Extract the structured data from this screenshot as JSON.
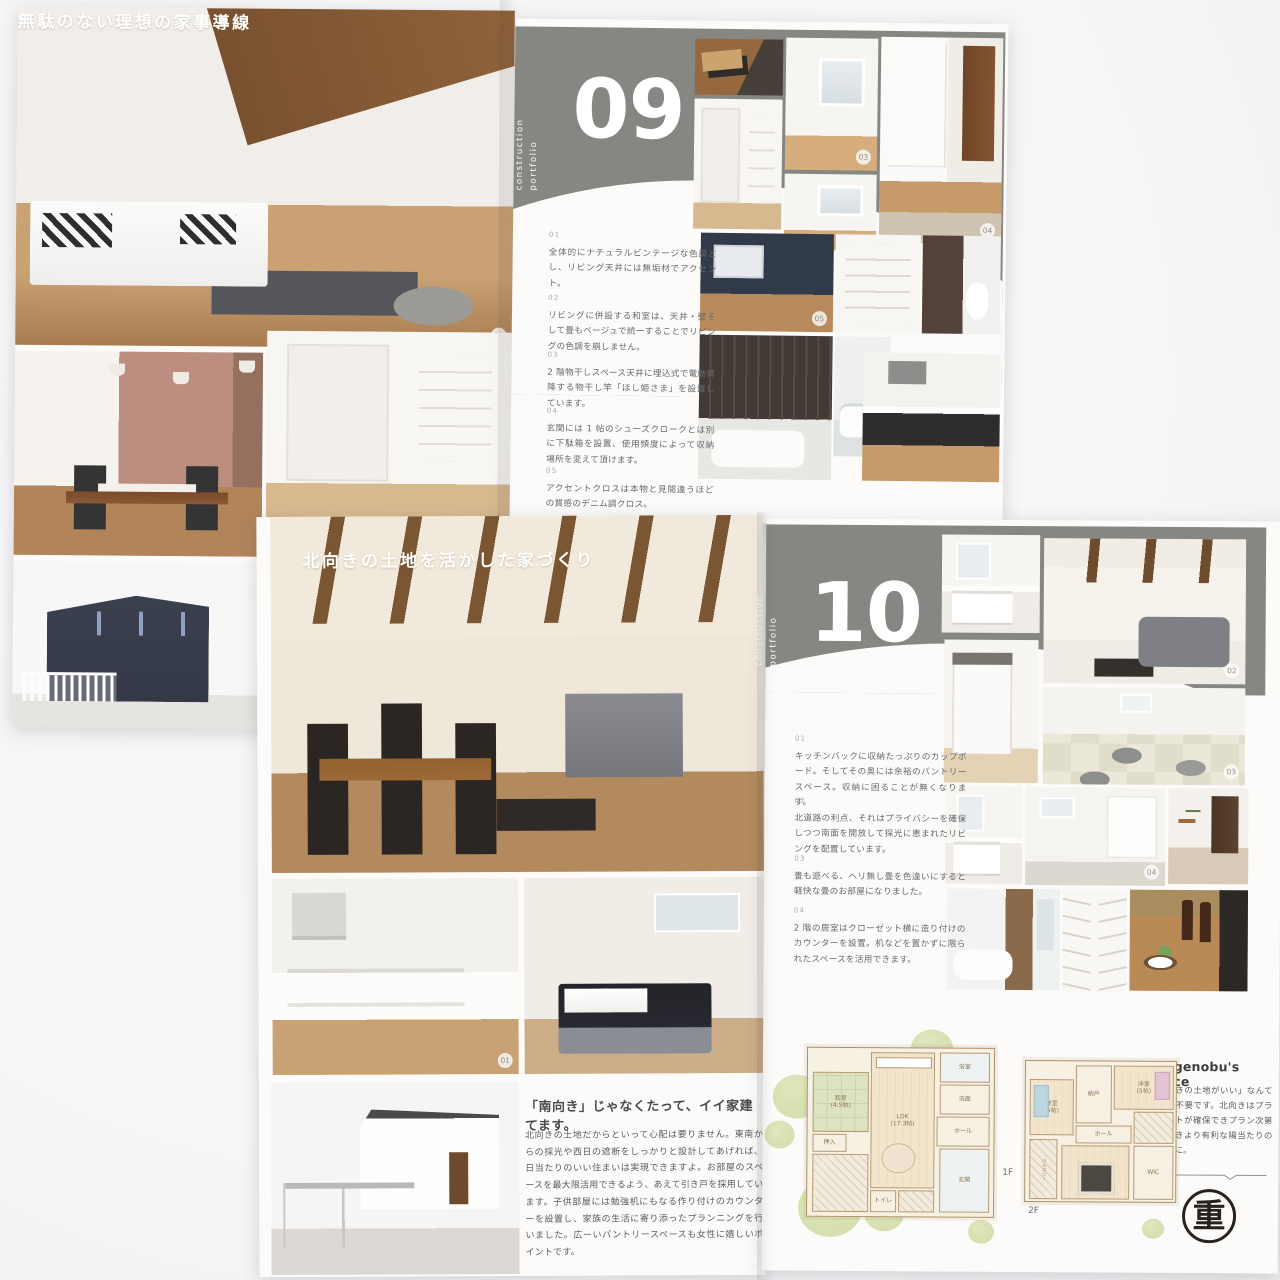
{
  "spread09": {
    "left": {
      "heading": "無駄のない理想の家事導線",
      "badge_living": "01"
    },
    "right": {
      "portfolio_line1": "construction",
      "portfolio_line2": "portfolio",
      "number": "09",
      "sections": [
        {
          "num": "01",
          "text": "全体的にナチュラルビンテージな色調とし、リビング天井には無垢材でアクセント。"
        },
        {
          "num": "02",
          "text": "リビングに併設する和室は、天井・壁そして畳もベージュで統一することでリビングの色調を崩しません。"
        },
        {
          "num": "03",
          "text": "2 階物干しスペース天井に埋込式で電動昇降する物干し竿「ほし姫さま」を設置しています。"
        },
        {
          "num": "04",
          "text": "玄関には 1 帖のシューズクロークとは別に下駄箱を設置、使用頻度によって収納場所を変えて頂けます。"
        },
        {
          "num": "05",
          "text": "アクセントクロスは本物と見間違うほどの質感のデニム調クロス。"
        }
      ],
      "badge_whiteroom": "03",
      "badge_hallway": "04",
      "badge_navy": "05"
    }
  },
  "spread10": {
    "left": {
      "heading": "北向きの土地を活かした家づくり",
      "badge_kitchen": "01",
      "title": "「南向き」じゃなくたって、イイ家建てます。",
      "body": "北向きの土地だからといって心配は要りません。東南からの採光や西日の遮断をしっかりと設計してあげれば、日当たりのいい住まいは実現できますよ。お部屋のスペースを最大限活用できるよう、あえて引き戸を採用しています。子供部屋には勉強机にもなる作り付けのカウンターを設置し、家族の生活に寄り添ったプランニングを行いました。広ーいパントリースペースも女性に嬉しいポイントです。"
    },
    "right": {
      "portfolio_line1": "construction",
      "portfolio_line2": "portfolio",
      "number": "10",
      "sections": [
        {
          "num": "01",
          "text": "キッチンバックに収納たっぷりのカップボード。そしてその奥には余裕のパントリースペース。収納に困ることが無くなります。"
        },
        {
          "num": "02",
          "text": "北道路の利点、それはプライバシーを確保しつつ南面を開放して採光に恵まれたリビングを配置しています。"
        },
        {
          "num": "03",
          "text": "畳も遊べる、ヘリ無し畳を色違いにすると軽快な畳のお部屋になりました。"
        },
        {
          "num": "04",
          "text": "2 階の居室はクローゼット横に造り付けのカウンターを設置。机などを置かずに限られたスペースを活用できます。"
        }
      ],
      "badge_living": "02",
      "badge_tatami": "03",
      "badge_bedroom": "04",
      "floorplan": {
        "label_1f": "1F",
        "label_2f": "2F",
        "rooms_1f": {
          "washitsu": "和室\n(4.5帖)",
          "ldk": "LDK\n(17.3帖)",
          "bath": "浴室",
          "senmen": "洗面",
          "genkan": "玄関",
          "hall": "ホール",
          "toilet": "トイレ",
          "oshiire": "押入"
        },
        "rooms_2f": {
          "yoshitsu1": "洋室\n(5帖)",
          "nando": "納戸",
          "yoshitsu2": "洋室\n(5帖)",
          "shinshitsu": "寝室\n(8帖)",
          "wic": "WIC",
          "hall": "ホール",
          "balcony": "バルコニー"
        }
      },
      "voice": {
        "title": "Shigenobu's Voice",
        "body": "「南向きの土地がいい」なんて考えは不要です。北向きはプライベートが確保できプラン次第で南向きより有利な陽当たりのいい家に。",
        "logo": "重"
      }
    }
  }
}
